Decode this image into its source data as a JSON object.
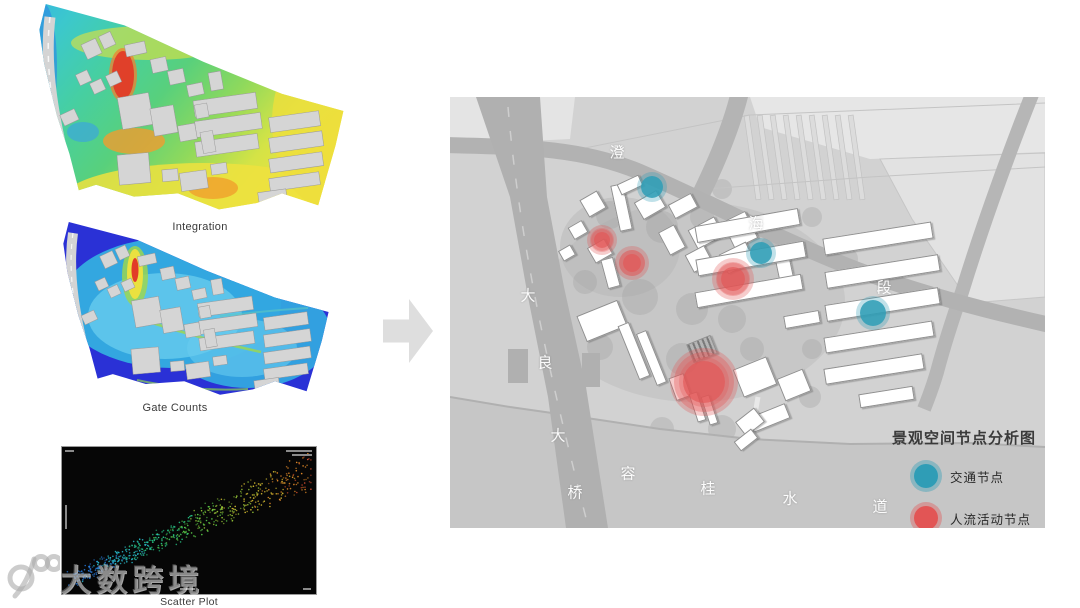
{
  "captions": {
    "integration": "Integration",
    "gate_counts": "Gate Counts",
    "scatter": "Scatter Plot"
  },
  "watermark": {
    "text": "大数跨境",
    "logo": "100-logo"
  },
  "site_outline": [
    [
      0.05,
      0.0
    ],
    [
      0.3,
      0.1
    ],
    [
      0.55,
      0.27
    ],
    [
      0.8,
      0.42
    ],
    [
      0.995,
      0.5
    ],
    [
      0.97,
      0.66
    ],
    [
      0.915,
      0.94
    ],
    [
      0.8,
      0.885
    ],
    [
      0.72,
      0.93
    ],
    [
      0.6,
      0.96
    ],
    [
      0.47,
      0.885
    ],
    [
      0.33,
      0.9
    ],
    [
      0.21,
      0.845
    ],
    [
      0.155,
      0.87
    ],
    [
      0.125,
      0.7
    ],
    [
      0.085,
      0.52
    ],
    [
      0.045,
      0.28
    ],
    [
      0.03,
      0.12
    ]
  ],
  "site_buildings": [
    [
      0.62,
      0.47,
      0.2,
      0.075,
      -8
    ],
    [
      0.63,
      0.565,
      0.21,
      0.075,
      -8
    ],
    [
      0.625,
      0.66,
      0.2,
      0.07,
      -8
    ],
    [
      0.84,
      0.55,
      0.16,
      0.07,
      -8
    ],
    [
      0.845,
      0.645,
      0.17,
      0.07,
      -8
    ],
    [
      0.845,
      0.74,
      0.17,
      0.065,
      -8
    ],
    [
      0.84,
      0.83,
      0.16,
      0.06,
      -8
    ],
    [
      0.77,
      0.9,
      0.09,
      0.055,
      -8
    ],
    [
      0.335,
      0.5,
      0.1,
      0.15,
      -10
    ],
    [
      0.425,
      0.545,
      0.075,
      0.13,
      -10
    ],
    [
      0.5,
      0.6,
      0.055,
      0.075,
      -10
    ],
    [
      0.545,
      0.5,
      0.04,
      0.065,
      -10
    ],
    [
      0.565,
      0.645,
      0.04,
      0.1,
      -10
    ],
    [
      0.33,
      0.77,
      0.1,
      0.14,
      -5
    ],
    [
      0.445,
      0.8,
      0.05,
      0.055,
      -5
    ],
    [
      0.52,
      0.825,
      0.085,
      0.085,
      -8
    ],
    [
      0.6,
      0.77,
      0.05,
      0.05,
      -8
    ],
    [
      0.195,
      0.21,
      0.05,
      0.075,
      -25
    ],
    [
      0.245,
      0.17,
      0.04,
      0.065,
      -25
    ],
    [
      0.17,
      0.345,
      0.04,
      0.055,
      -25
    ],
    [
      0.215,
      0.385,
      0.04,
      0.055,
      -25
    ],
    [
      0.265,
      0.35,
      0.04,
      0.055,
      -25
    ],
    [
      0.335,
      0.21,
      0.065,
      0.055,
      -12
    ],
    [
      0.41,
      0.285,
      0.05,
      0.065,
      -12
    ],
    [
      0.465,
      0.34,
      0.05,
      0.065,
      -12
    ],
    [
      0.525,
      0.4,
      0.05,
      0.055,
      -12
    ],
    [
      0.59,
      0.36,
      0.04,
      0.085,
      -10
    ],
    [
      0.125,
      0.53,
      0.05,
      0.055,
      -25
    ]
  ],
  "integration_palette": [
    "#35b8e0",
    "#3cc8cc",
    "#46cfa2",
    "#58d07c",
    "#8fd95c",
    "#d4e346",
    "#eee23c",
    "#f0a02c",
    "#e23b28"
  ],
  "gate_palette": [
    "#2a31d6",
    "#33a7e0",
    "#67ccee",
    "#9fd84a",
    "#efe23e",
    "#e23b28"
  ],
  "chart_data": {
    "type": "scatter",
    "title": "Scatter Plot",
    "n": 620,
    "seed": 42,
    "trend": {
      "x0": 0.04,
      "y0": 0.9,
      "x1": 0.98,
      "y1": 0.16
    },
    "lane_spread": 0.028,
    "jitter": 0.05,
    "palette": [
      "#2878d8",
      "#28b8c8",
      "#28c888",
      "#58c848",
      "#98c838",
      "#d0b830",
      "#e08828"
    ],
    "background": "#060606",
    "note": "dense positive-correlation point band, blue-teal lower-left to yellow-orange upper-right"
  },
  "map": {
    "legend": {
      "title": "景观空间节点分析图",
      "items": [
        {
          "label": "交通节点",
          "color": "#2f9db6"
        },
        {
          "label": "人流活动节点",
          "color": "#e25555"
        }
      ]
    },
    "labels": {
      "road": [
        {
          "ch": "澄",
          "x": 167,
          "y": 55
        },
        {
          "ch": "海",
          "x": 306,
          "y": 126
        },
        {
          "ch": "段",
          "x": 434,
          "y": 190
        }
      ],
      "bridge": [
        {
          "ch": "大",
          "x": 78,
          "y": 198
        },
        {
          "ch": "良",
          "x": 95,
          "y": 265
        },
        {
          "ch": "大",
          "x": 108,
          "y": 338
        },
        {
          "ch": "桥",
          "x": 125,
          "y": 395
        }
      ],
      "water": [
        {
          "ch": "容",
          "x": 178,
          "y": 376
        },
        {
          "ch": "桂",
          "x": 258,
          "y": 391
        },
        {
          "ch": "水",
          "x": 340,
          "y": 401
        },
        {
          "ch": "道",
          "x": 430,
          "y": 409
        }
      ]
    },
    "nodes": {
      "traffic": [
        {
          "x": 202,
          "y": 90,
          "r": 11
        },
        {
          "x": 311,
          "y": 156,
          "r": 11
        },
        {
          "x": 423,
          "y": 216,
          "r": 13
        }
      ],
      "activity": [
        {
          "x": 152,
          "y": 143,
          "r": 11
        },
        {
          "x": 182,
          "y": 166,
          "r": 13
        },
        {
          "x": 283,
          "y": 182,
          "r": 17
        },
        {
          "x": 254,
          "y": 285,
          "r": 30,
          "inner": 21
        }
      ]
    },
    "buildings": [
      [
        143,
        107,
        20,
        20,
        -30
      ],
      [
        171,
        110,
        13,
        47,
        -12
      ],
      [
        200,
        108,
        26,
        20,
        -30
      ],
      [
        233,
        109,
        26,
        16,
        -28
      ],
      [
        180,
        88,
        24,
        12,
        -25
      ],
      [
        150,
        154,
        20,
        18,
        -30
      ],
      [
        160,
        176,
        13,
        30,
        -15
      ],
      [
        222,
        143,
        18,
        26,
        -28
      ],
      [
        256,
        136,
        30,
        22,
        -28
      ],
      [
        290,
        133,
        26,
        30,
        -26
      ],
      [
        249,
        162,
        22,
        20,
        -28
      ],
      [
        287,
        161,
        30,
        22,
        -26
      ],
      [
        334,
        172,
        15,
        30,
        -12
      ],
      [
        128,
        133,
        16,
        14,
        -30
      ],
      [
        117,
        156,
        14,
        12,
        -30
      ],
      [
        152,
        224,
        44,
        28,
        -22
      ],
      [
        184,
        254,
        12,
        58,
        -22
      ],
      [
        201,
        261,
        11,
        56,
        -22
      ],
      [
        230,
        290,
        16,
        24,
        -20
      ],
      [
        252,
        252,
        26,
        20,
        -22,
        "dark"
      ],
      [
        305,
        280,
        36,
        30,
        -22
      ],
      [
        344,
        288,
        28,
        24,
        -22
      ],
      [
        319,
        321,
        40,
        16,
        -22
      ],
      [
        300,
        325,
        24,
        18,
        -38
      ],
      [
        247,
        310,
        9,
        30,
        -18
      ],
      [
        259,
        313,
        9,
        30,
        -18
      ],
      [
        296,
        343,
        22,
        12,
        -38
      ],
      [
        297,
        128,
        105,
        17,
        -10
      ],
      [
        301,
        161,
        110,
        17,
        -10
      ],
      [
        299,
        194,
        108,
        16,
        -10
      ],
      [
        352,
        222,
        36,
        13,
        -10
      ],
      [
        428,
        141,
        110,
        17,
        -9
      ],
      [
        432,
        174,
        115,
        17,
        -9
      ],
      [
        432,
        207,
        115,
        17,
        -9
      ],
      [
        429,
        240,
        110,
        16,
        -9
      ],
      [
        424,
        272,
        100,
        16,
        -9
      ],
      [
        436,
        300,
        55,
        14,
        -9
      ]
    ],
    "trees": [
      [
        160,
        118,
        14
      ],
      [
        212,
        130,
        16
      ],
      [
        252,
        120,
        12
      ],
      [
        190,
        200,
        18
      ],
      [
        242,
        212,
        16
      ],
      [
        282,
        222,
        14
      ],
      [
        322,
        150,
        12
      ],
      [
        272,
        92,
        10
      ],
      [
        150,
        250,
        13
      ],
      [
        232,
        262,
        16
      ],
      [
        302,
        252,
        12
      ],
      [
        362,
        252,
        10
      ],
      [
        396,
        162,
        12
      ],
      [
        362,
        120,
        10
      ],
      [
        272,
        332,
        14
      ],
      [
        212,
        332,
        12
      ],
      [
        135,
        185,
        12
      ],
      [
        360,
        300,
        11
      ]
    ]
  }
}
